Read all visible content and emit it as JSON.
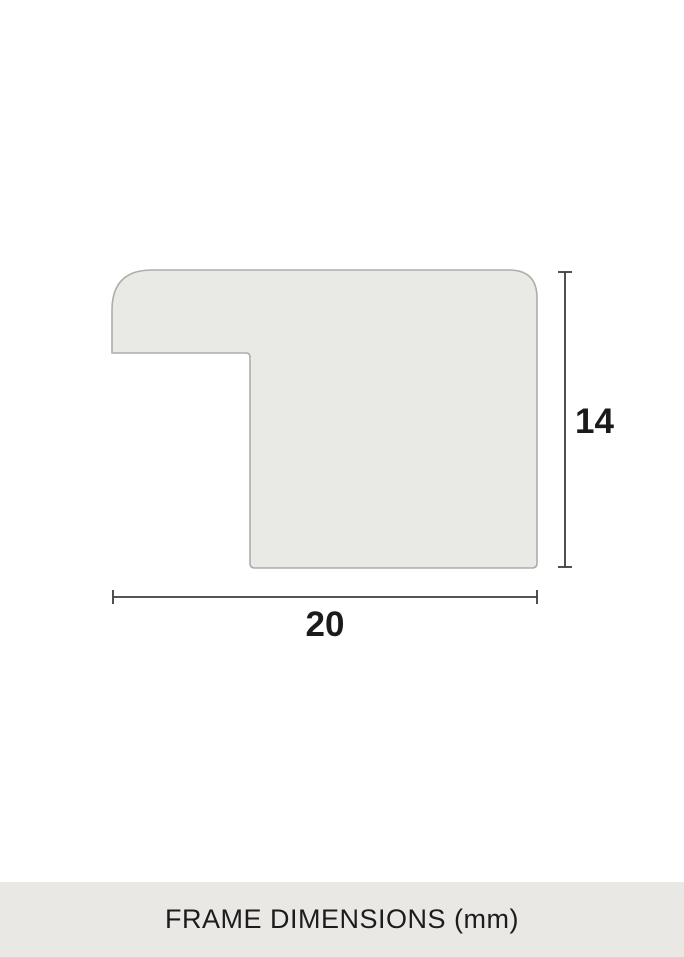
{
  "diagram": {
    "type": "frame-profile-cross-section",
    "unit": "mm",
    "width_mm": 20,
    "height_mm": 14,
    "width_label": "20",
    "height_label": "14"
  },
  "footer": {
    "caption": "FRAME DIMENSIONS (mm)"
  },
  "colors": {
    "page_background": "#FFFFFF",
    "profile_fill": "#E9E9E5",
    "profile_stroke": "#AEADA8",
    "dimension_line": "#3D3D3D",
    "label_text": "#1B1B1B",
    "footer_background": "#E9E8E4",
    "footer_text": "#1C1C1C"
  }
}
